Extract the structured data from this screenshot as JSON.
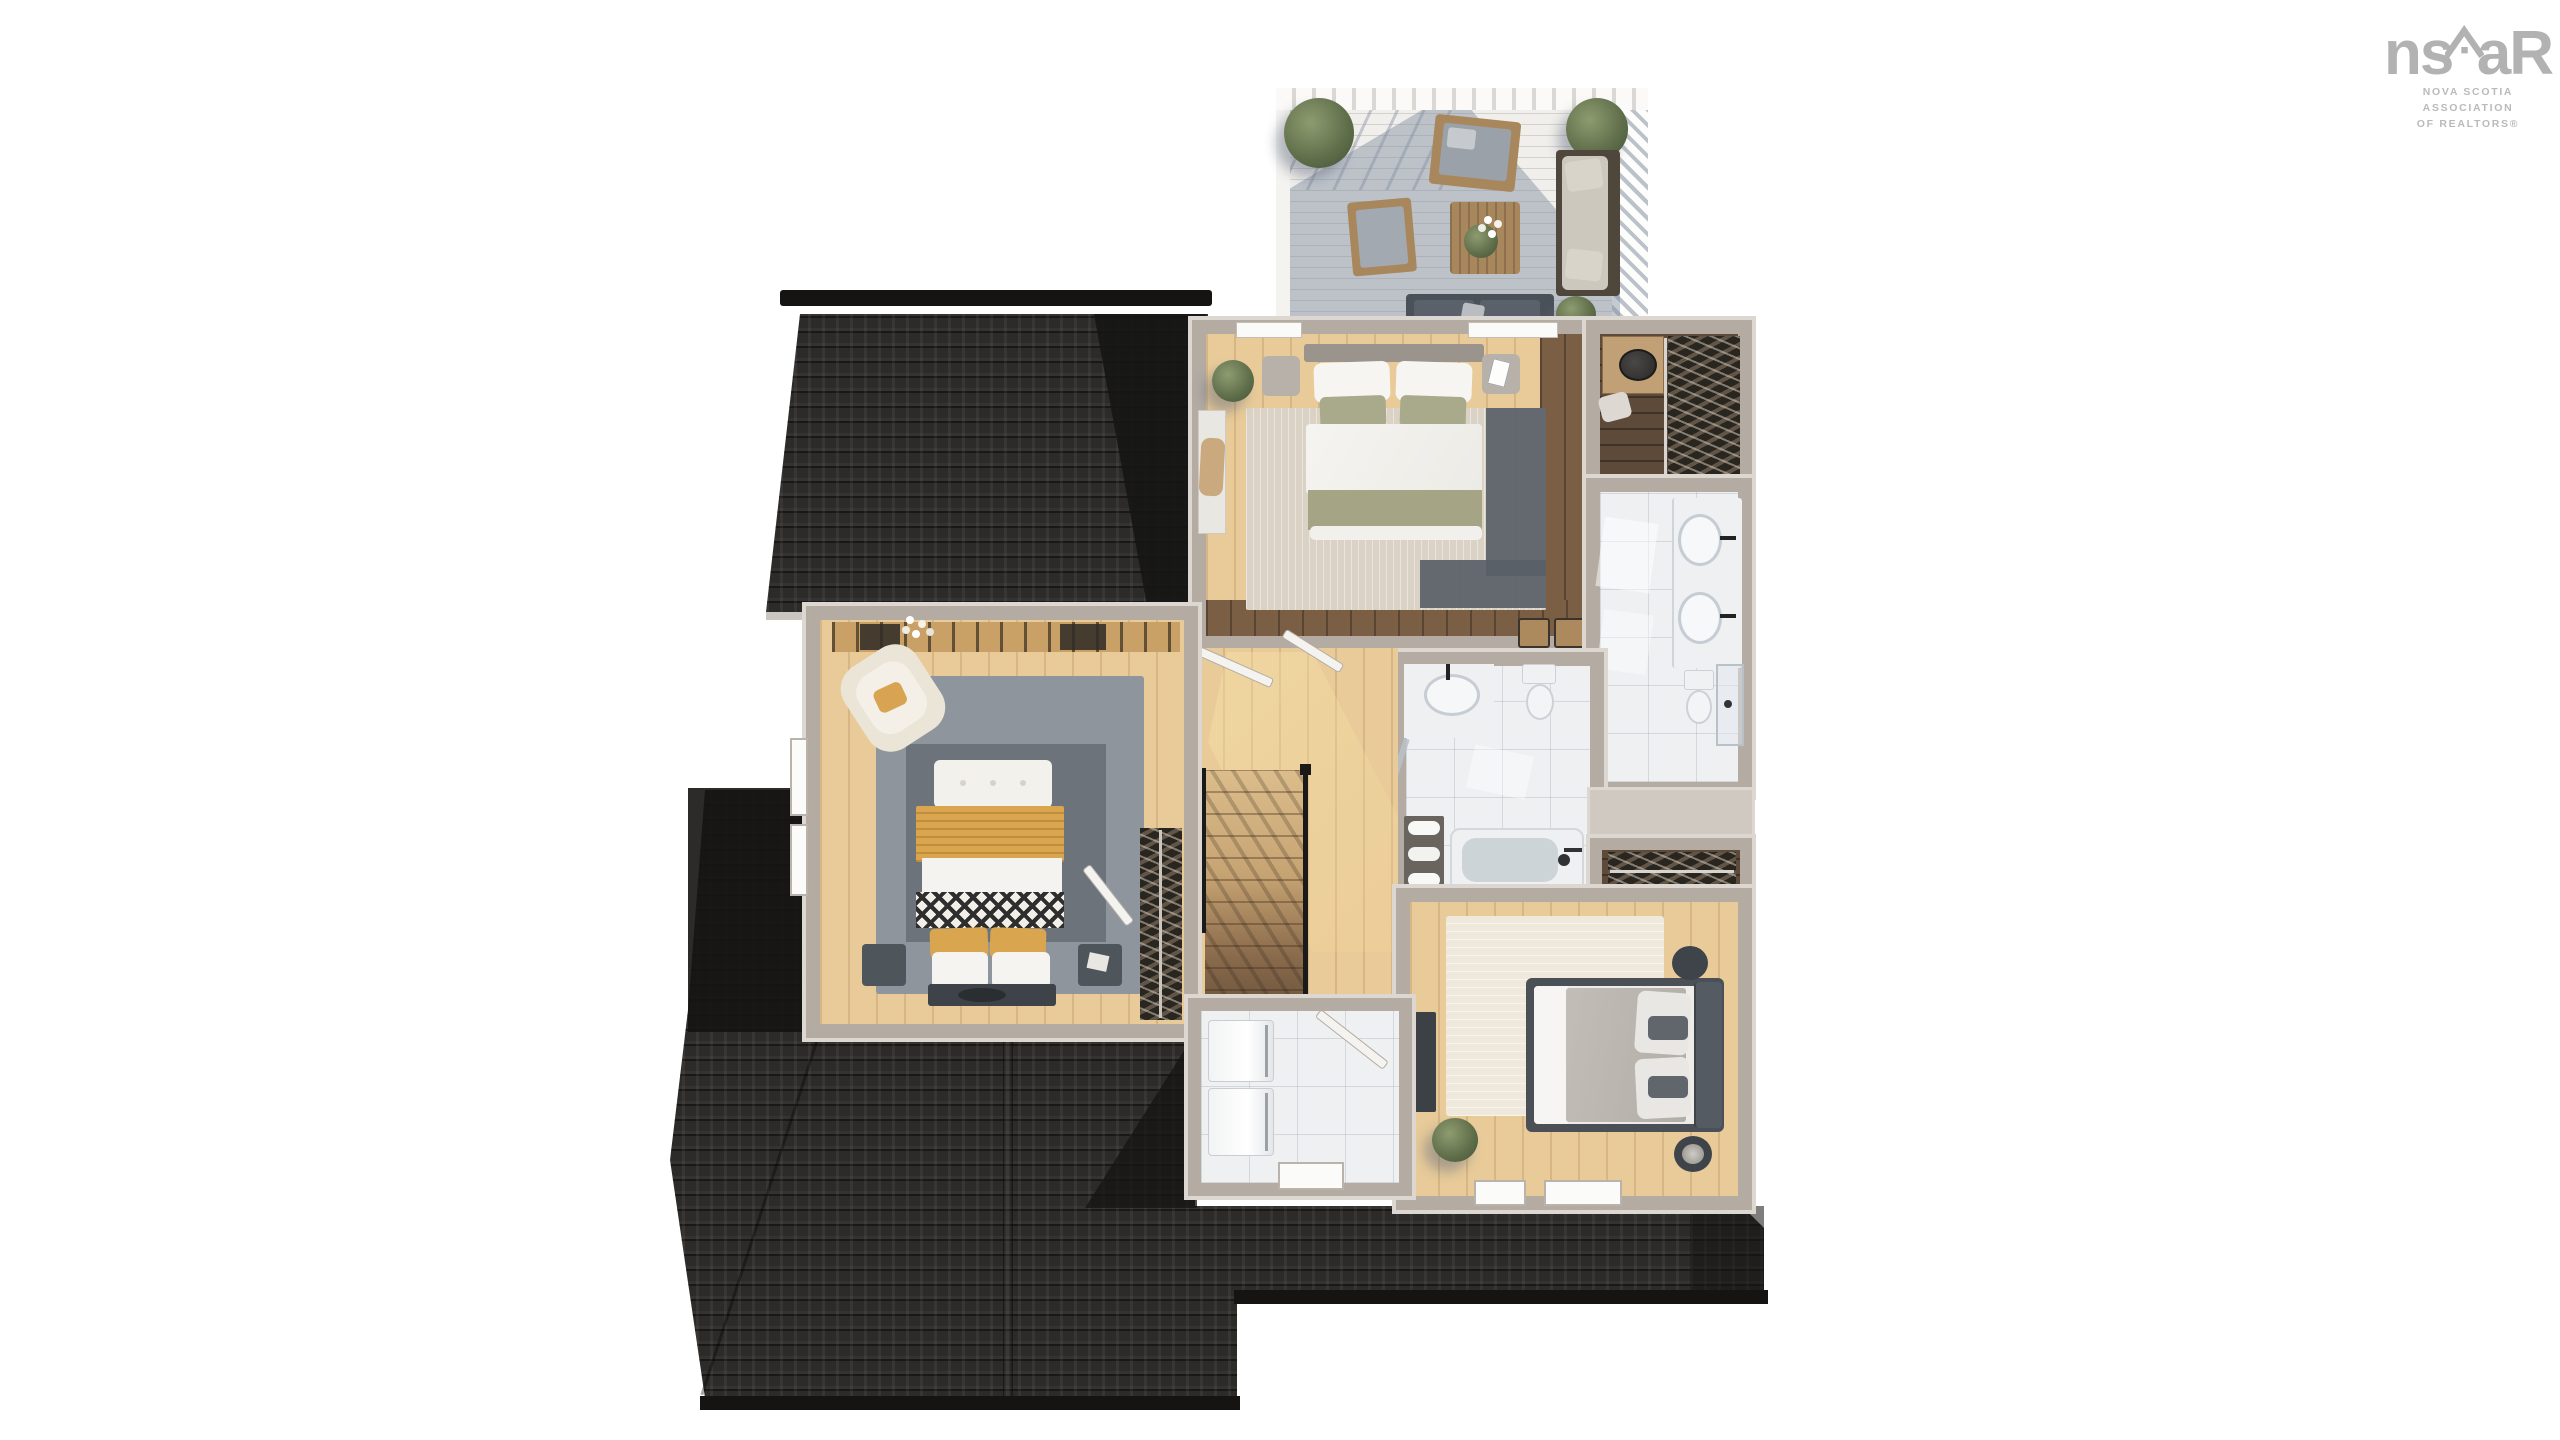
{
  "page": {
    "background_color": "#ffffff",
    "description": "3D rendered top-down floor plan of a house second storey on a white background"
  },
  "logo": {
    "brand_left": "ns",
    "brand_right": "aR",
    "tagline_line1": "NOVA SCOTIA ASSOCIATION",
    "tagline_line2": "OF REALTORS®",
    "color": "#b2b2b2"
  },
  "palette": {
    "roof_shingle": "#2d2b29",
    "roof_shadow": "#151413",
    "wall": "#b4aba3",
    "wall_light": "#dcd7d1",
    "floor_oak": "#e8cb99",
    "floor_walnut": "#7b5f45",
    "floor_closet_dark": "#5e4a38",
    "floor_marble": "#eef0f2",
    "deck_board": "#f0efeb",
    "deck_shadow": "#7e8ba0",
    "rug_beige": "#dad3c5",
    "rug_gray": "#8e959d",
    "rug_cream": "#efe9db",
    "bedding_white": "#f4f3f0",
    "bedding_sage": "#a8a889",
    "bedding_mustard": "#d9a64f",
    "bedding_taupe": "#b7b2ac",
    "furniture_dark": "#4c5258",
    "furniture_wood": "#ab8a61",
    "foliage": "#5d6c48"
  },
  "scene": {
    "type": "floor-plan-3d-render",
    "rooms": [
      "deck",
      "primary-bedroom",
      "walk-in-closet",
      "ensuite-bathroom",
      "main-bathroom",
      "hallway-stairs",
      "bedroom-2",
      "bedroom-3",
      "laundry-room"
    ]
  }
}
